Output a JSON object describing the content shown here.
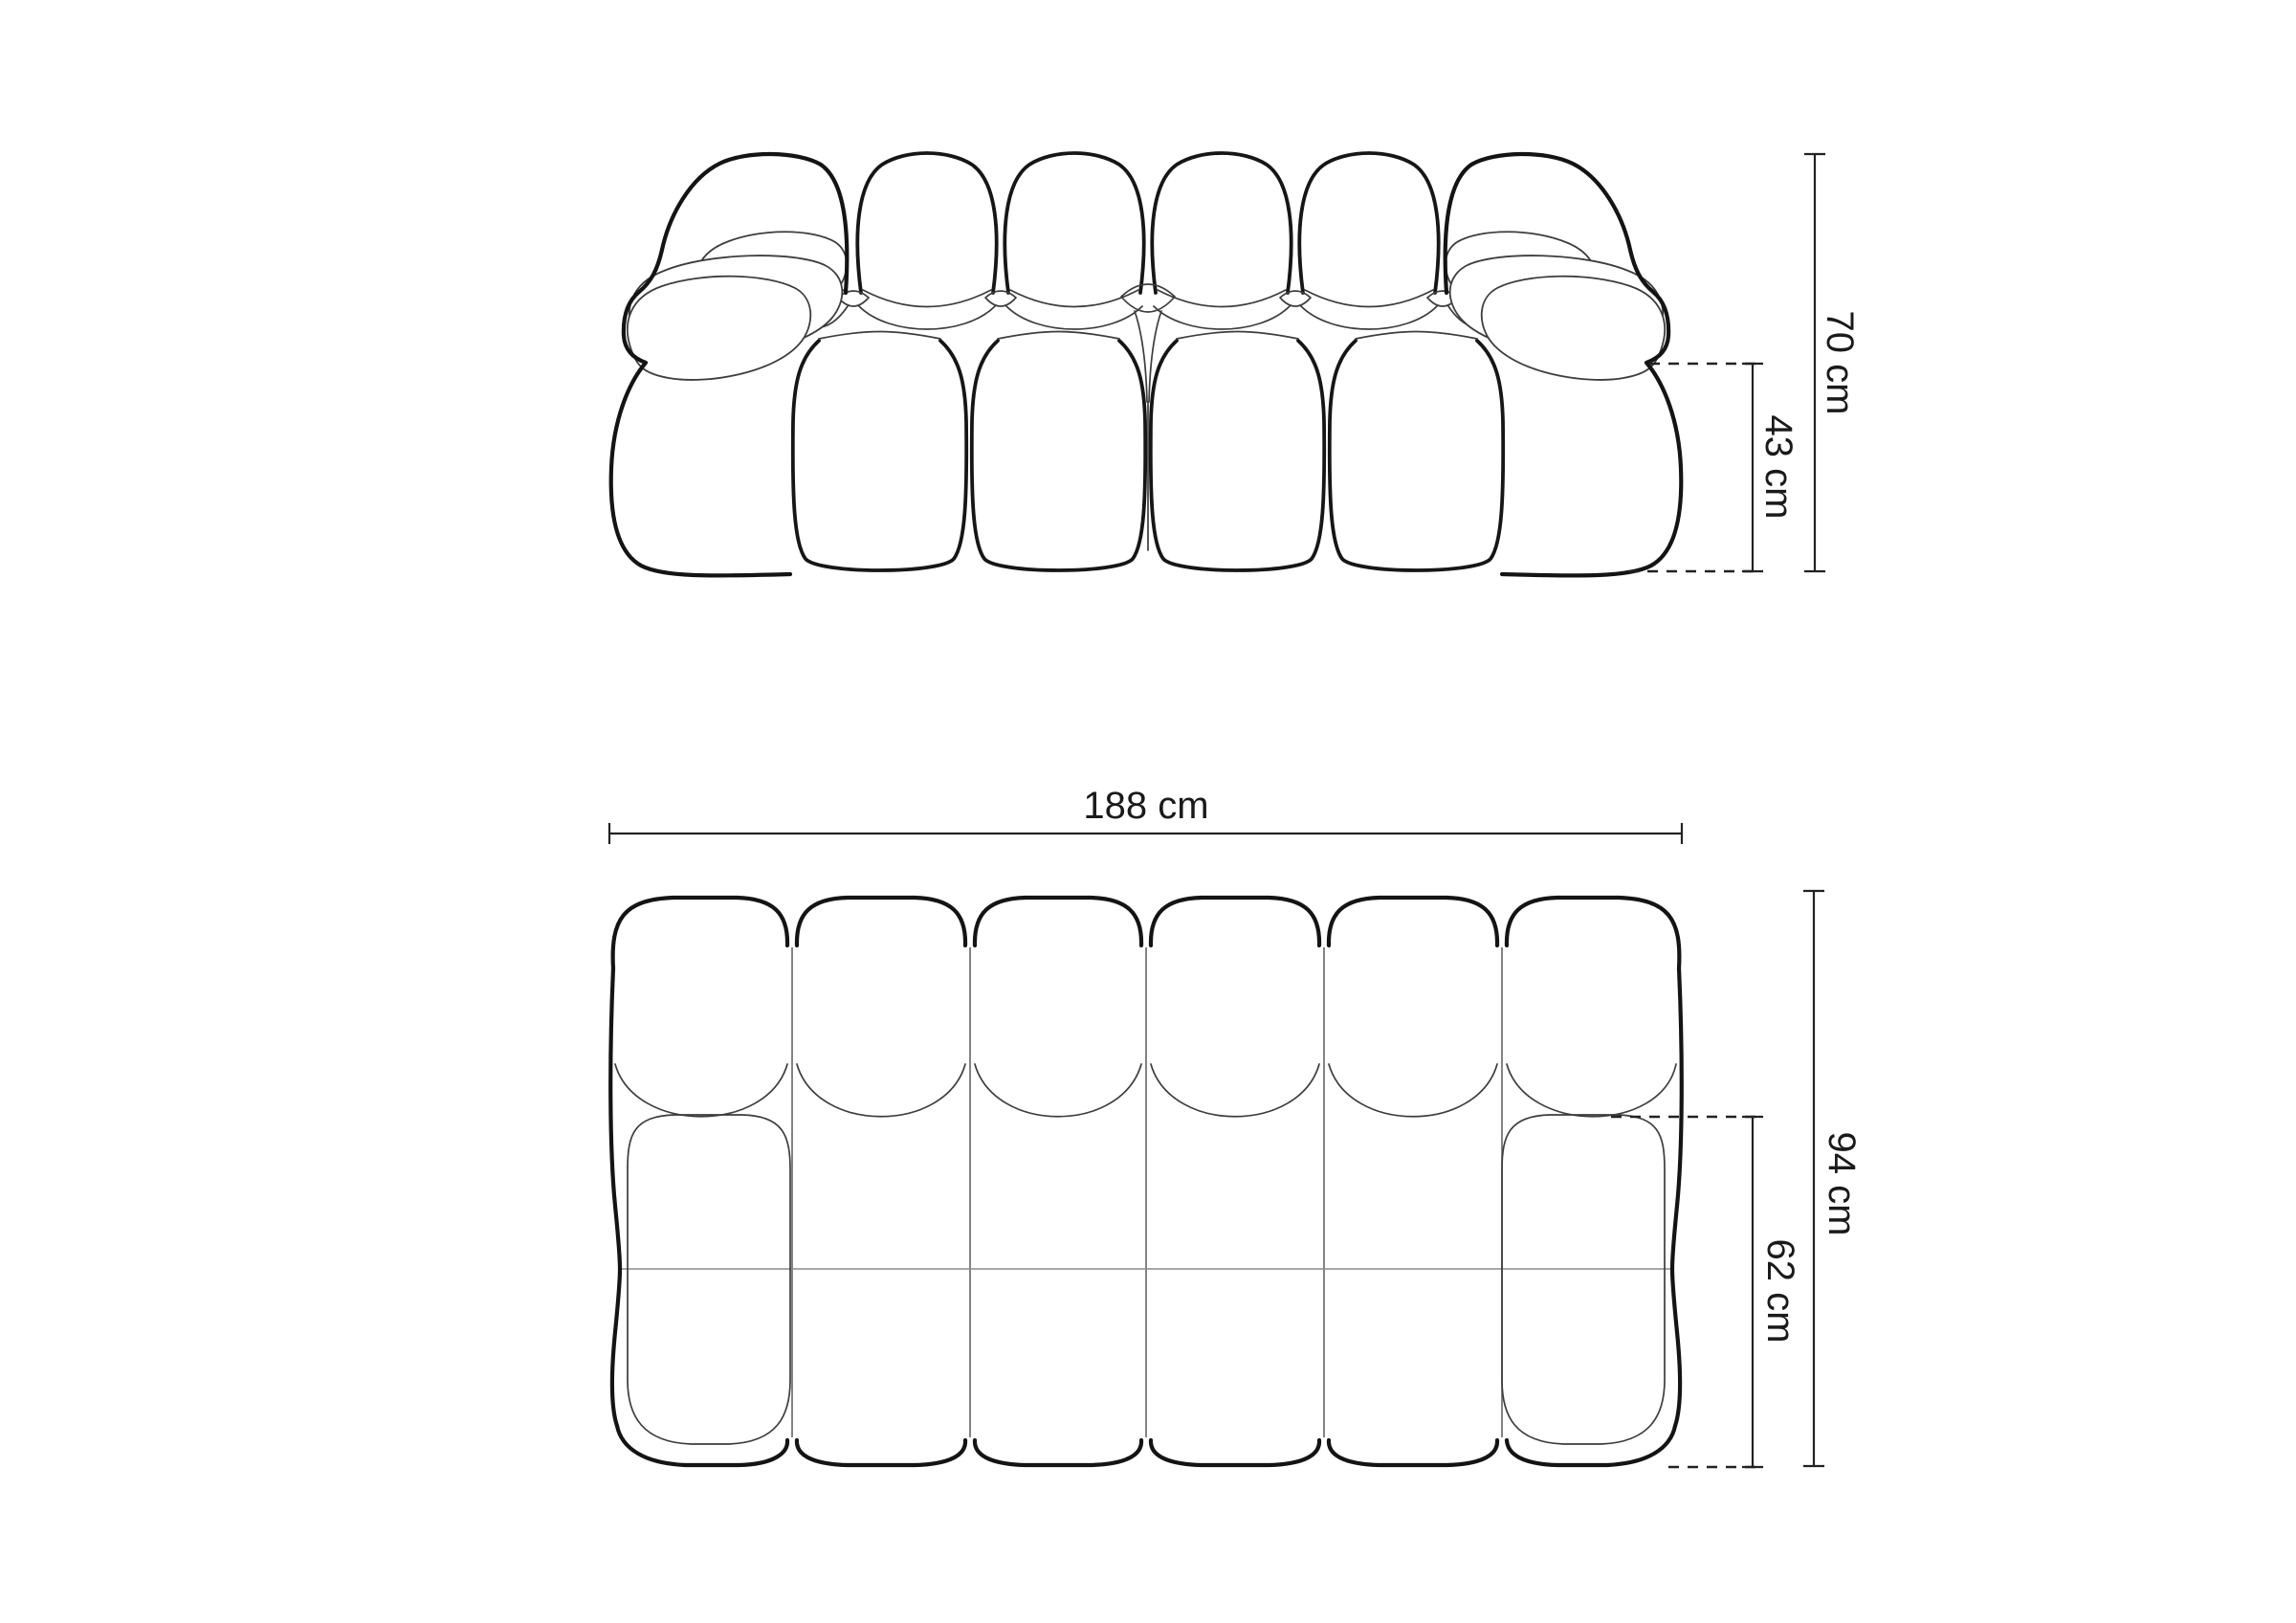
{
  "diagram": {
    "front_view": {
      "overall_height_label": "70 cm",
      "armrest_height_label": "43 cm"
    },
    "top_view": {
      "overall_width_label": "188 cm",
      "overall_depth_label": "94 cm",
      "seat_depth_label": "62 cm"
    },
    "colors": {
      "outline_bold": "#141414",
      "outline_thin": "#3d3d3d",
      "module_divider": "#6f6f6f",
      "center_midline": "#8a8a8a",
      "dimension_line": "#222222",
      "label_text": "#1a1a1a",
      "background": "#ffffff"
    }
  }
}
